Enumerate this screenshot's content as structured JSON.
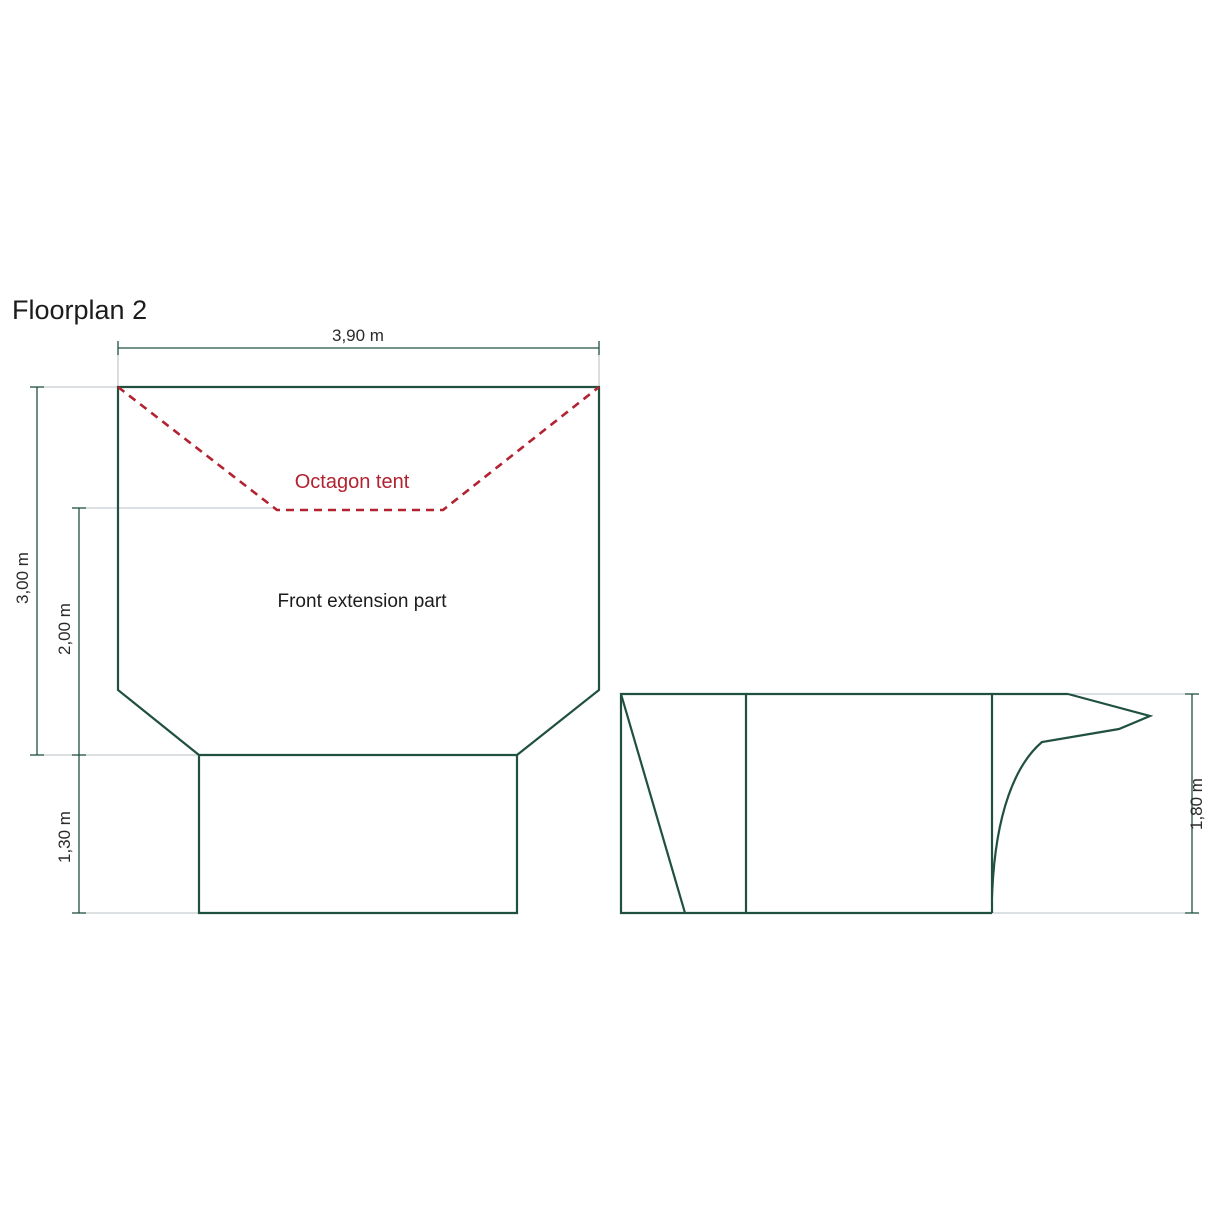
{
  "title": "Floorplan 2",
  "colors": {
    "line_green": "#20503f",
    "dashed_red": "#b22230",
    "text_black": "#1c1c1c",
    "extension_gray": "#b9c2c6"
  },
  "plan_view": {
    "tent_label": "Octagon tent",
    "extension_label": "Front extension part",
    "dimensions": {
      "width": "3,90 m",
      "height": "3,00 m",
      "front_depth": "2,00 m",
      "porch_depth": "1,30 m"
    }
  },
  "side_view": {
    "dimensions": {
      "height": "1,80 m"
    }
  }
}
